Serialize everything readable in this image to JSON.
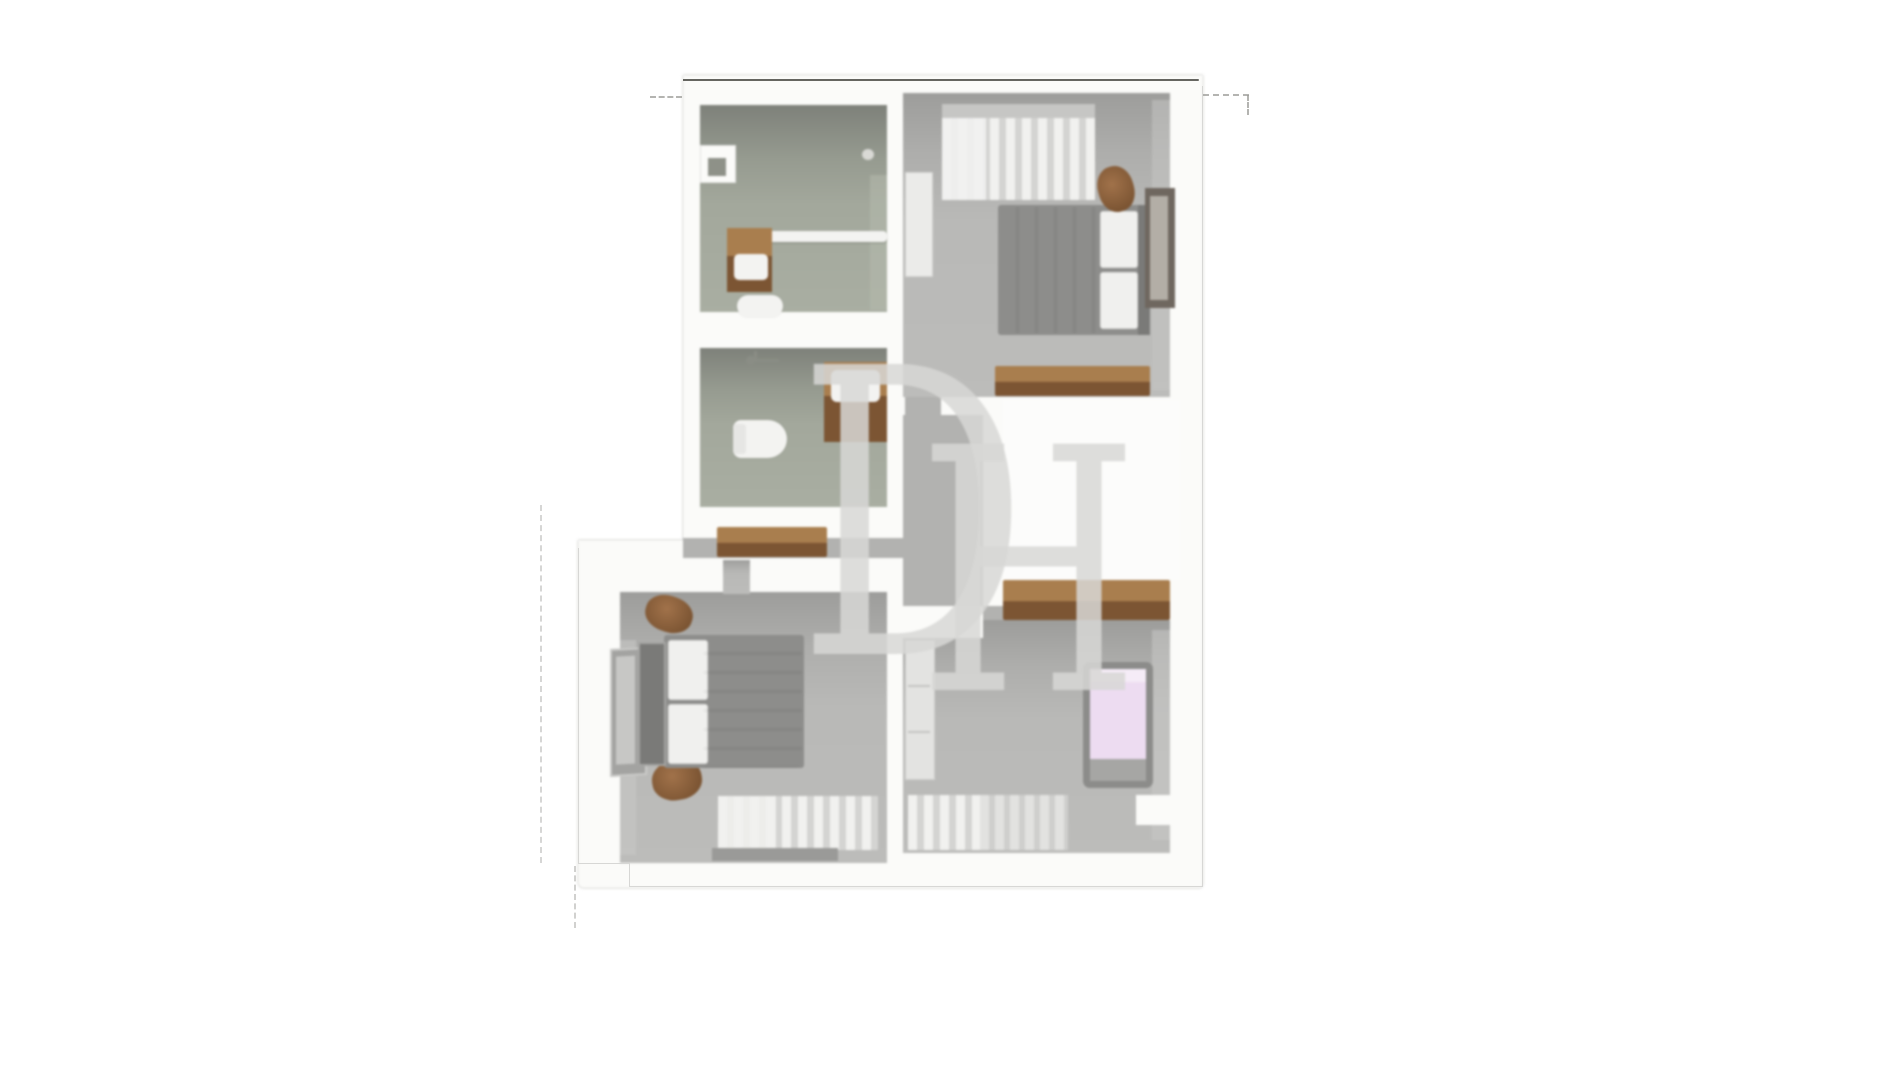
{
  "watermark": {
    "letter_d": "D",
    "letter_h": "H"
  },
  "colors": {
    "page-bg": "#ffffff",
    "wall-white": "#fbfbf9",
    "plan-edge-dark": "#50504a",
    "ghost-line": "#9b9b97",
    "faint-line": "#d7d7d5",
    "bath-face": "#7e817a",
    "bath-floor": "#a9aea2",
    "bed-face": "#9d9d9b",
    "bed-floor": "#bcbcba",
    "corridor-floor": "#b2b2b0",
    "wood-top": "#a97e4e",
    "wood-front": "#7c5533",
    "duvet": "#f4f4f2",
    "pillow": "#f0f0ee",
    "frame-grey": "#8d8d8b",
    "headboard-grey": "#7a7a78",
    "wardrobe-dark": "#6f675f",
    "mirror-grey": "#b3aea6",
    "white-furniture": "#ebebe9",
    "curtain-light": "#f1f1ef",
    "curtain-dark": "#d4d4d2",
    "curtain-sheer": "#e2e2e0",
    "pelmet": "#c6c6c4",
    "rod-dark": "#9a9a98",
    "pink-mattress": "#eddcf1",
    "porcelain": "#f3f3f1",
    "niche-hole": "#8e9188",
    "fixture-grey": "#8a8d85",
    "watermark-grey": "#d8d8d6",
    "stair-void": "#fcfcfb"
  },
  "plan": {
    "rooms": [
      {
        "id": "shower-room",
        "furniture": [
          "wall-niche",
          "vanity-with-sink",
          "toilet",
          "shower-screen"
        ]
      },
      {
        "id": "bathroom",
        "furniture": [
          "shower-fixture",
          "vanity-with-sink",
          "toilet"
        ]
      },
      {
        "id": "bedroom-top-right",
        "furniture": [
          "window-curtains",
          "white-shelf-unit",
          "double-bed",
          "pouf",
          "wardrobe-mirror",
          "sideboard"
        ]
      },
      {
        "id": "landing",
        "furniture": [
          "sideboard",
          "stairwell"
        ]
      },
      {
        "id": "bedroom-bottom-left",
        "furniture": [
          "wardrobe",
          "double-bed",
          "pouf",
          "window-curtains"
        ]
      },
      {
        "id": "bedroom-bottom-right",
        "furniture": [
          "tall-cupboard",
          "single-bed",
          "window-curtains"
        ]
      }
    ]
  }
}
